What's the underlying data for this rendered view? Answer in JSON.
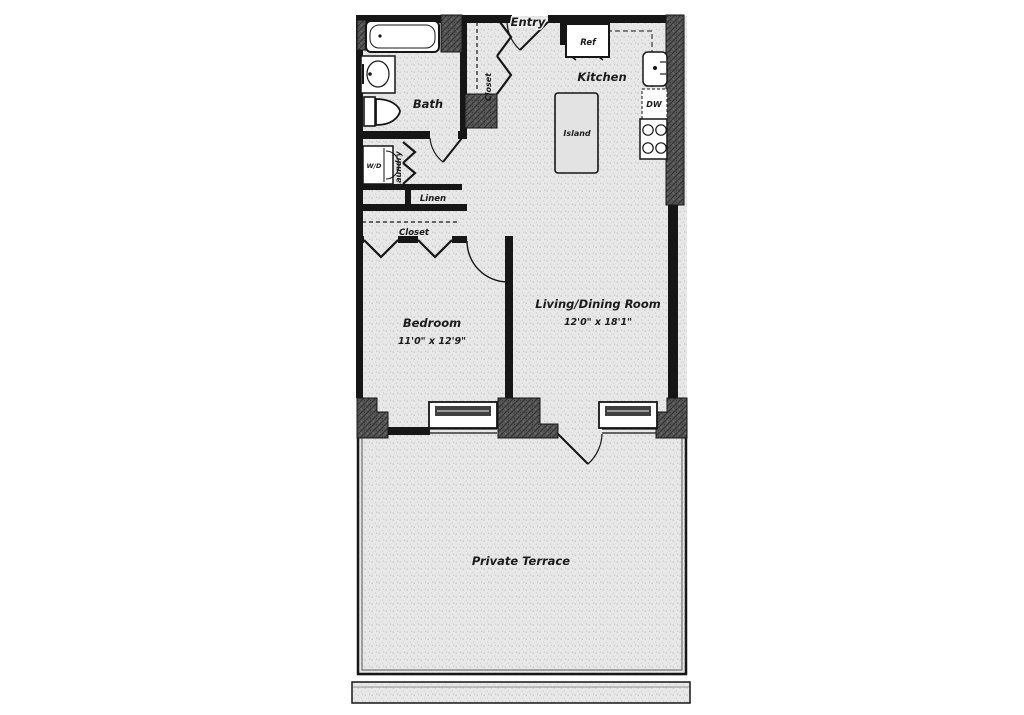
{
  "floorplan": {
    "title": "One-bedroom apartment floor plan",
    "rooms": {
      "entry": {
        "label": "Entry"
      },
      "entry_closet": {
        "label": "Closet"
      },
      "kitchen": {
        "label": "Kitchen"
      },
      "bath": {
        "label": "Bath"
      },
      "laundry": {
        "label": "Laundry"
      },
      "linen": {
        "label": "Linen"
      },
      "bedroom_closet": {
        "label": "Closet"
      },
      "bedroom": {
        "label": "Bedroom",
        "dims": "11'0\" x 12'9\""
      },
      "living_dining": {
        "label": "Living/Dining Room",
        "dims": "12'0\" x 18'1\""
      },
      "terrace": {
        "label": "Private Terrace"
      }
    },
    "fixtures": {
      "refrigerator": {
        "label": "Ref"
      },
      "dishwasher": {
        "label": "DW"
      },
      "island": {
        "label": "Island"
      },
      "washer_dryer": {
        "label": "W/D"
      }
    },
    "colors": {
      "wall": "#161616",
      "floor": "#e8e8e8",
      "pier": "#555555",
      "background": "#ffffff",
      "text": "#1b1b1b"
    }
  }
}
